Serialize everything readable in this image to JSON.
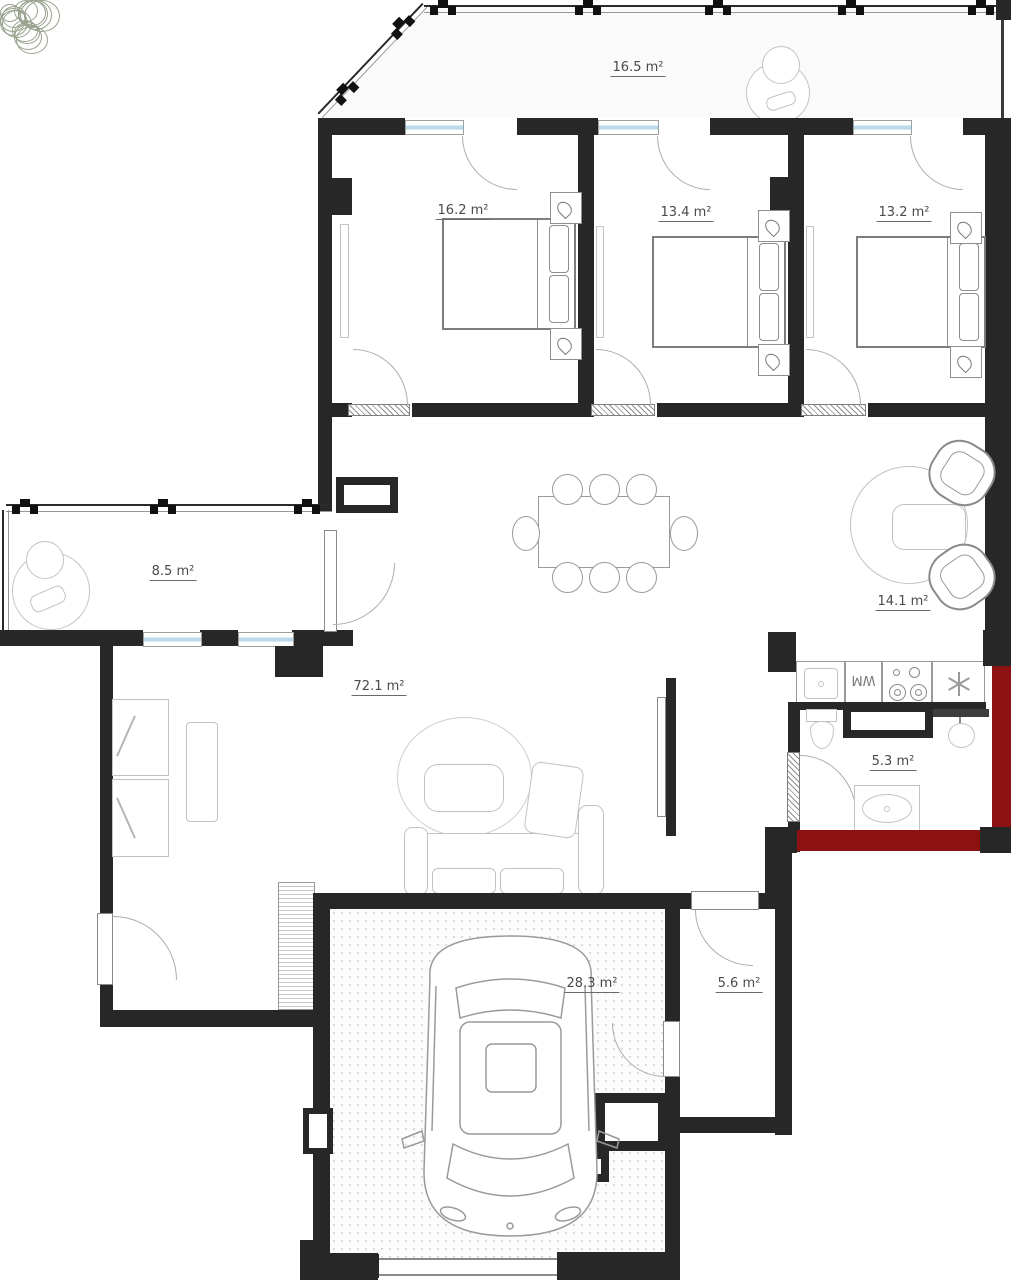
{
  "plan": {
    "type": "apartment-floor-plan",
    "colors": {
      "wall": "#272727",
      "accent_wall": "#8c1212",
      "window_glass": "#b9d9ea",
      "furniture_line": "#9a9a9a",
      "label_text": "#4a4a4a"
    },
    "rooms": [
      {
        "id": "terrace",
        "area_label": "16.5 m²"
      },
      {
        "id": "bedroom-1",
        "area_label": "16.2 m²"
      },
      {
        "id": "bedroom-2",
        "area_label": "13.4 m²"
      },
      {
        "id": "bedroom-3",
        "area_label": "13.2 m²"
      },
      {
        "id": "balcony",
        "area_label": "8.5 m²"
      },
      {
        "id": "kitchen-dining",
        "area_label": "14.1 m²"
      },
      {
        "id": "living-room",
        "area_label": "72.1 m²"
      },
      {
        "id": "bathroom",
        "area_label": "5.3 m²"
      },
      {
        "id": "garage",
        "area_label": "28.3 m²"
      },
      {
        "id": "storage",
        "area_label": "5.6 m²"
      }
    ],
    "labels": {
      "washing_machine": "WM"
    },
    "icons": {
      "railing_post": "castle-post",
      "fridge": "snowflake",
      "nightstand_lamp": "teardrop-lamp"
    }
  }
}
